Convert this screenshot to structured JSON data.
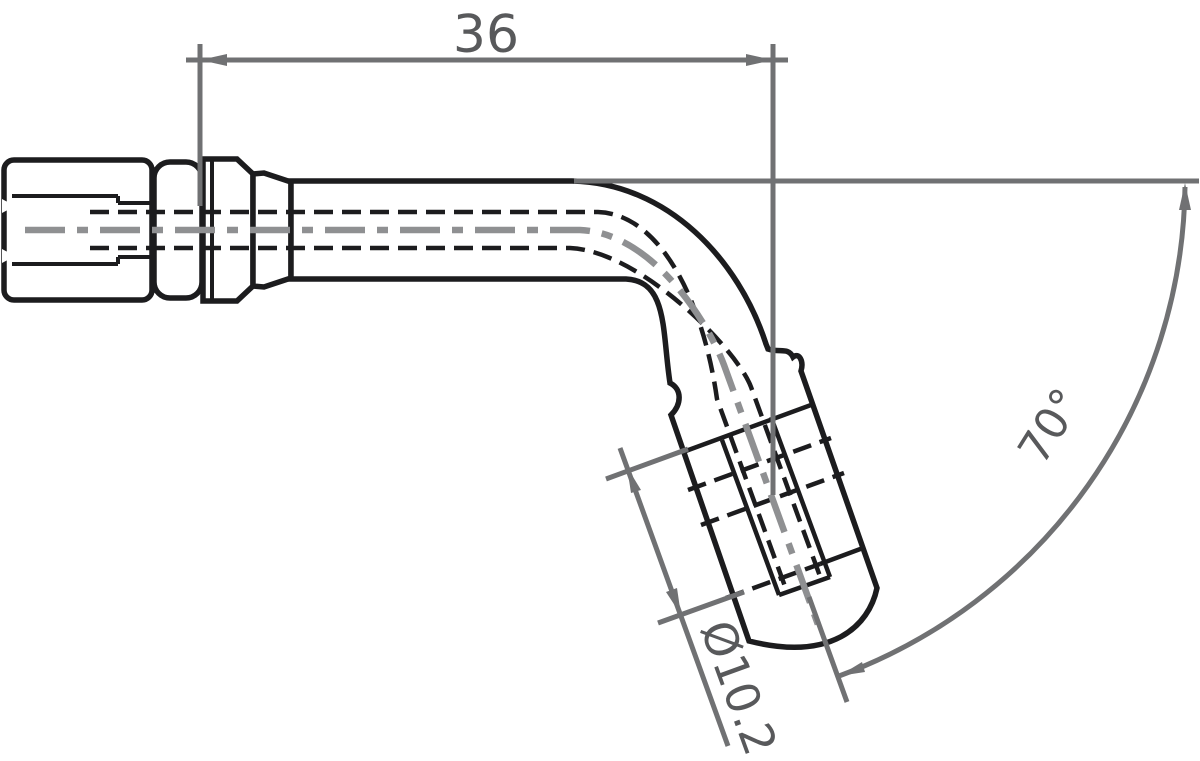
{
  "drawing": {
    "title": "70-degree elbow hose end fitting - dimensioned side view",
    "type": "technical drawing, 2D CAD style",
    "dimensions": {
      "length_label": "36",
      "diameter_label": "Ø10.2",
      "angle_label": "70°"
    },
    "colors": {
      "background": "#ffffff",
      "part_line": "#1c1c1e",
      "dimension_line": "#707173",
      "dimension_text": "#58595b",
      "centerline": "#8f9092"
    }
  }
}
